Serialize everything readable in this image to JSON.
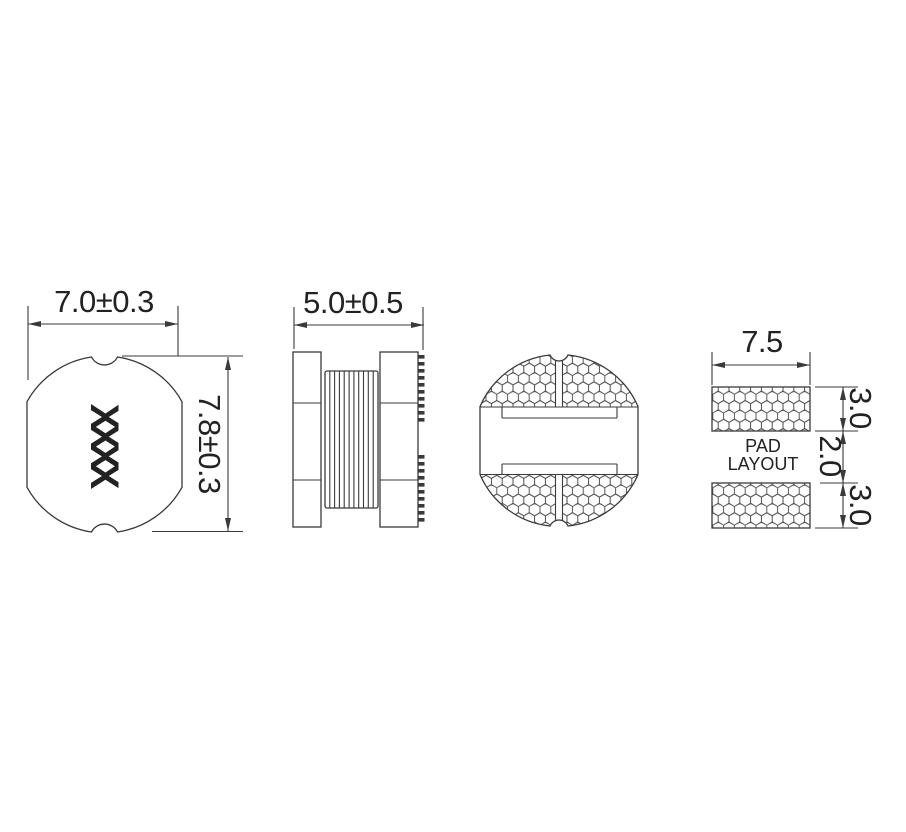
{
  "drawing": {
    "top_view": {
      "width_dim": "7.0±0.3",
      "height_dim": "7.8±0.3",
      "marking": "XXXX"
    },
    "side_view": {
      "width_dim": "5.0±0.5"
    },
    "pad_layout": {
      "width_dim": "7.5",
      "top_pad_height_dim": "3.0",
      "gap_dim": "2.0",
      "bottom_pad_height_dim": "3.0",
      "label_line1": "PAD",
      "label_line2": "LAYOUT"
    },
    "colors": {
      "line": "#3a3a3a",
      "text": "#222222",
      "background": "#ffffff"
    }
  }
}
